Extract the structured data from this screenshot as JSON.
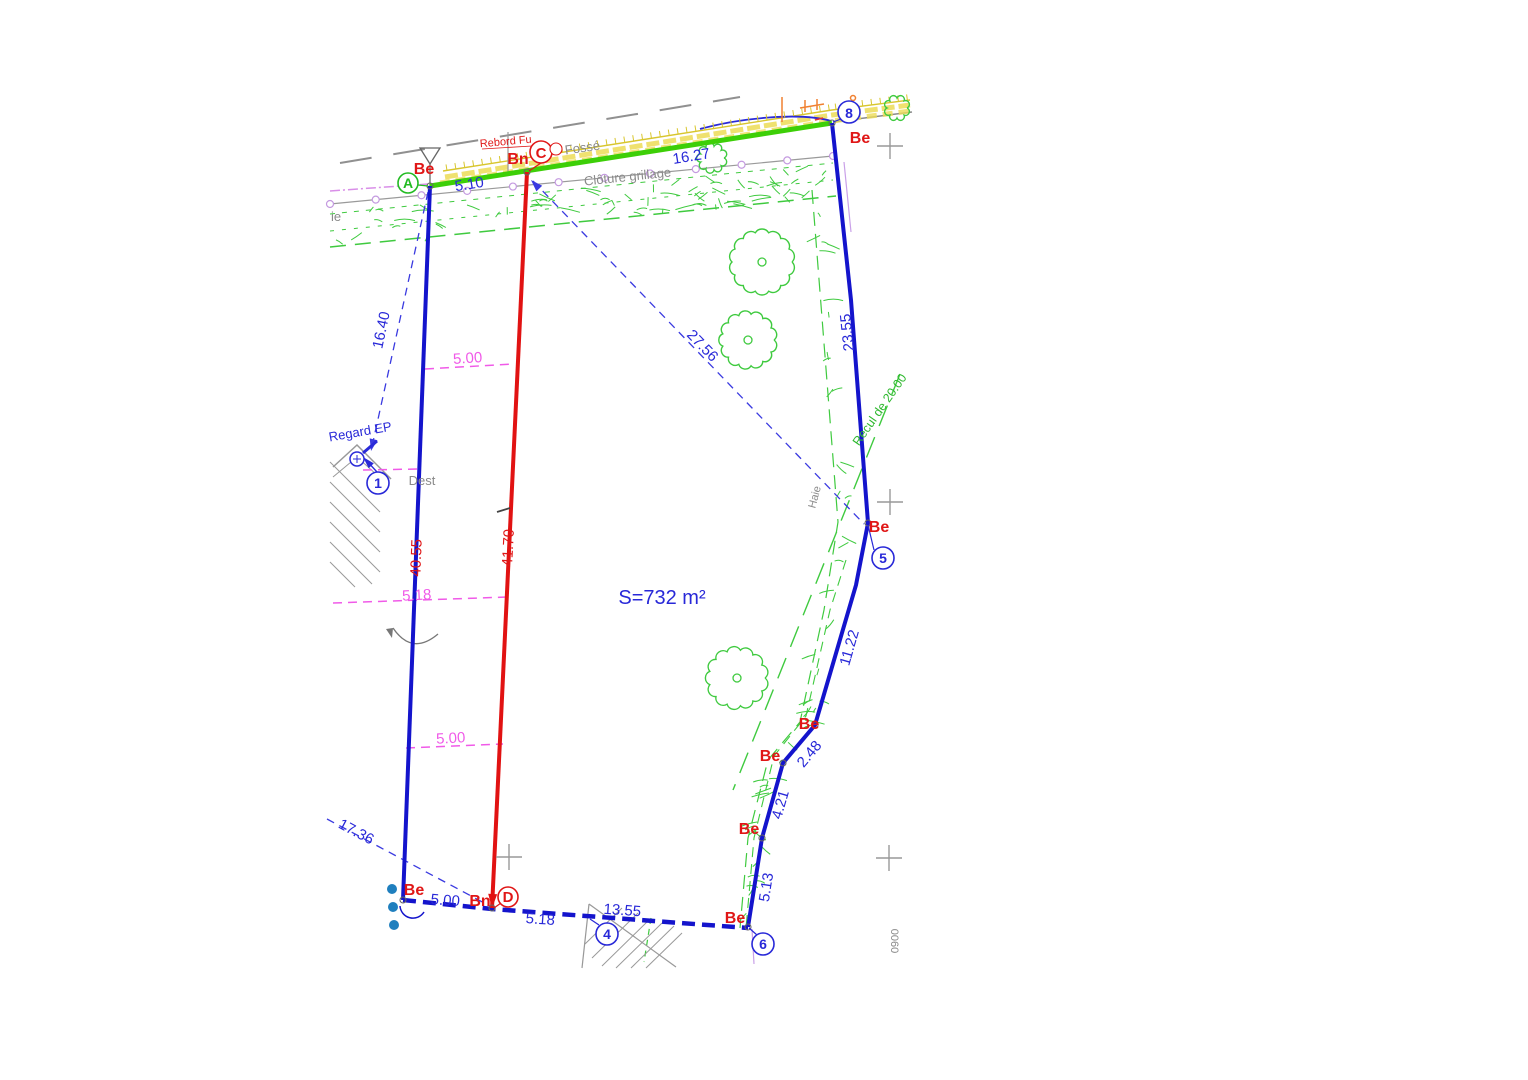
{
  "drawing": {
    "area_label": "S=732 m²",
    "points": {
      "A": "A",
      "C": "C",
      "D": "D",
      "n1": "1",
      "n4": "4",
      "n5": "5",
      "n6": "6",
      "n8": "8"
    },
    "markers": {
      "be": "Be",
      "bn": "Bn"
    },
    "dims": {
      "ac": "5.10",
      "c8": "16.27",
      "a1": "16.40",
      "left": "40.55",
      "mid": "41.70",
      "r1": "23.55",
      "diag": "27.56",
      "r2": "11.22",
      "r3": "2.48",
      "r4": "4.21",
      "r5": "5.13",
      "bl": "17.36",
      "b1": "5.00",
      "b2": "5.18",
      "b3": "13.55",
      "off50a": "5.00",
      "off518": "5.18",
      "off50b": "5.00"
    },
    "texts": {
      "fosse": "Fossé",
      "rebord": "Rebord Fu",
      "cloture": "Clôture grillage",
      "regard": "Regard EP",
      "dest": "Dest",
      "haie": "Haie",
      "ie": "ie",
      "recul": "Recul de 20.00",
      "sheet": "0060"
    },
    "colors": {
      "boundary_blue": "#1414cc",
      "dim_blue": "#2828d8",
      "red": "#e01616",
      "limit_green": "#3dcf07",
      "vegetation_green": "#3fca3f",
      "magenta": "#f05ae8",
      "fence_violet": "#c49ae0",
      "wall_yellow": "#e0cf3a",
      "gray": "#8a8a8a",
      "teal_dot": "#1f7fbe",
      "orange": "#f08030"
    }
  }
}
